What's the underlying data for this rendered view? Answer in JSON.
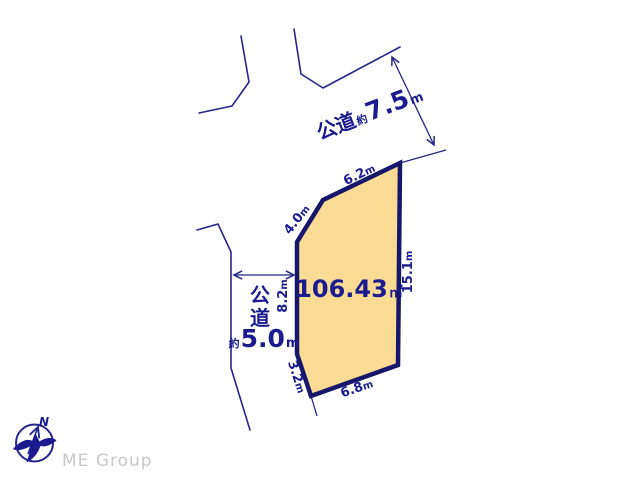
{
  "colors": {
    "line_navy": "#26268a",
    "border_navy": "#16166b",
    "parcel_fill": "#f9db93",
    "text_navy": "#1b1b8f",
    "brand_gray": "#c8c8c8"
  },
  "parcel": {
    "area_value": "106.43",
    "area_unit": "㎡"
  },
  "edges": {
    "top": {
      "value": "6.2",
      "unit": "m"
    },
    "upper_left": {
      "value": "4.0",
      "unit": "m"
    },
    "left": {
      "value": "8.2",
      "unit": "m"
    },
    "lower_left": {
      "value": "3.2",
      "unit": "m"
    },
    "bottom": {
      "value": "6.8",
      "unit": "m"
    },
    "right": {
      "value": "15.1",
      "unit": "m"
    }
  },
  "roads": {
    "top": {
      "name": "公道",
      "approx": "約",
      "value": "7.5",
      "unit": "m"
    },
    "left": {
      "name_chars": [
        "公",
        "道"
      ],
      "approx": "約",
      "value": "5.0",
      "unit": "m"
    }
  },
  "compass": {
    "north_label": "N"
  },
  "footer": {
    "brand": "ME Group"
  }
}
